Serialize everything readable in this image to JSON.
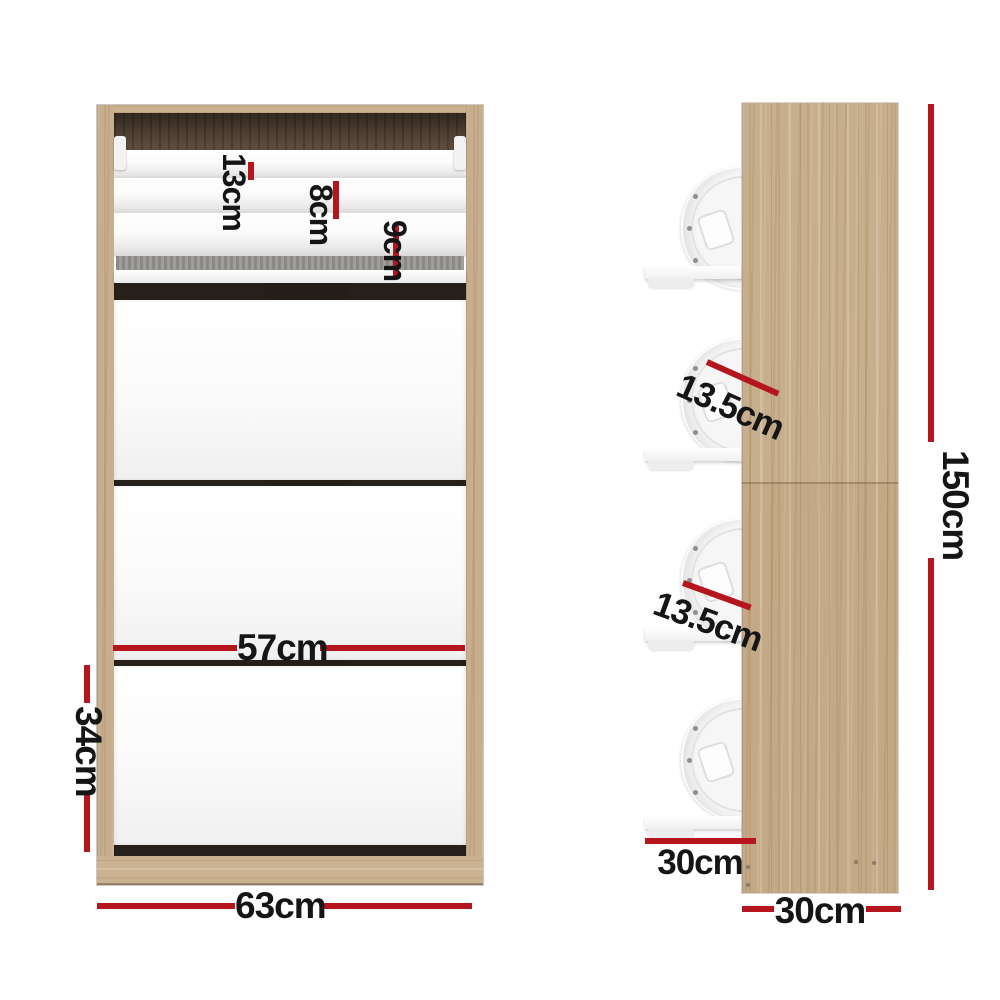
{
  "diagram": {
    "product": "shoe-cabinet-dimension-diagram",
    "views": {
      "front": {
        "labels": {
          "tier_top": "13cm",
          "tier_mid": "8cm",
          "tier_bottom": "9cm",
          "inner_width": "57cm",
          "drawer_height": "34cm",
          "overall_width": "63cm"
        }
      },
      "side": {
        "labels": {
          "spacing_upper": "13.5cm",
          "spacing_lower": "13.5cm",
          "shelf_depth": "30cm",
          "overall_depth": "30cm",
          "overall_height": "150cm"
        }
      }
    },
    "colors": {
      "dimension_line": "#b5161e",
      "label_text": "#151515",
      "wood_light": "#c7ae8c",
      "wood_interior_dark": "#5d4c3d",
      "panel_white": "#f6f6f6",
      "background": "#ffffff"
    }
  }
}
